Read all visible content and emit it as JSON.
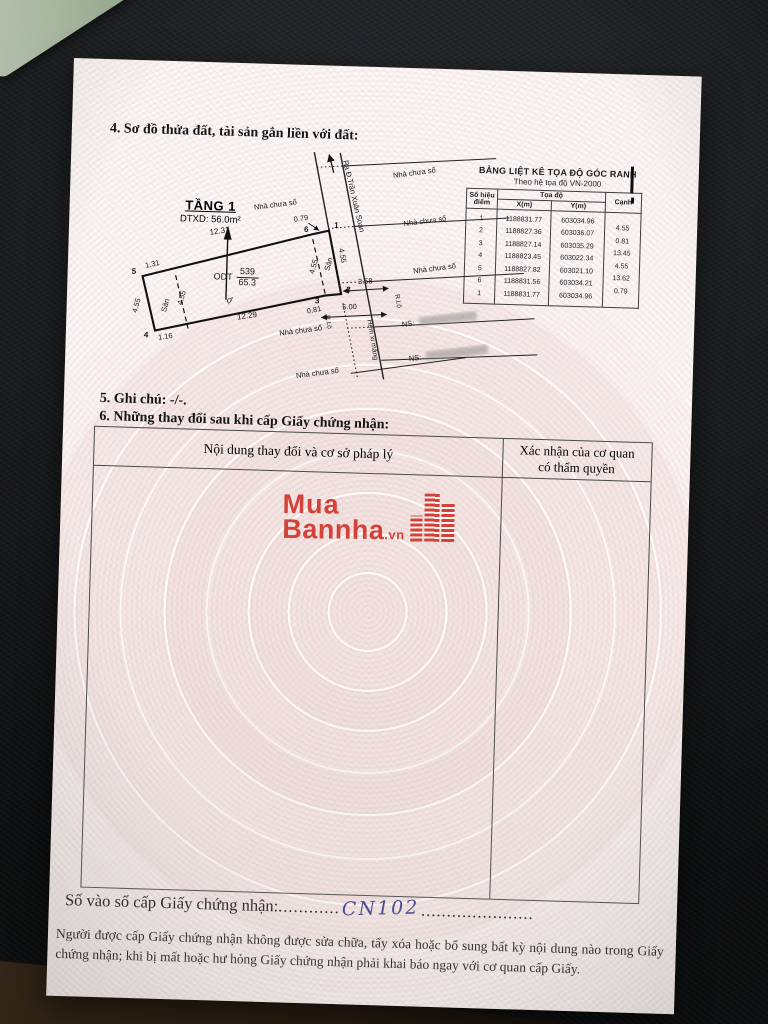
{
  "sections": {
    "s4": "4. Sơ đồ thửa đất, tài sản gắn liền với đất:",
    "s5": "5. Ghi chú: -/-.",
    "s6": "6. Những thay đổi sau khi cấp Giấy chứng nhận:"
  },
  "coord_table": {
    "title": "BẢNG LIỆT KÊ TỌA ĐỘ GÓC RANH",
    "subtitle": "Theo hệ tọa độ VN-2000",
    "col_point": "Số hiệu điểm",
    "col_coords": "Tọa độ",
    "col_x": "X(m)",
    "col_y": "Y(m)",
    "col_edge": "Cạnh",
    "rows": [
      {
        "p": "1",
        "x": "1188831.77",
        "y": "603034.96",
        "edge": ""
      },
      {
        "p": "2",
        "x": "1188827.36",
        "y": "603036.07",
        "edge": "4.55"
      },
      {
        "p": "3",
        "x": "1188827.14",
        "y": "603035.29",
        "edge": "0.81"
      },
      {
        "p": "4",
        "x": "1188823.45",
        "y": "603022.34",
        "edge": "13.45"
      },
      {
        "p": "5",
        "x": "1188827.82",
        "y": "603021.10",
        "edge": "4.55"
      },
      {
        "p": "6",
        "x": "1188831.56",
        "y": "603034.21",
        "edge": "13.62"
      },
      {
        "p": "1",
        "x": "1188831.77",
        "y": "603034.96",
        "edge": "0.79"
      }
    ]
  },
  "diagram": {
    "floor_label": "TẦNG 1",
    "floor_area": "DTXD: 56.0m²",
    "land_use": "ODT",
    "plot_number": "539",
    "plot_area": "65.3",
    "plot_letter": "ợ",
    "street_label": "Ra Đ.Trần Xuân Soạn",
    "alley_label": "Hẻm xi măng",
    "road_label_1": "R.Lộ",
    "road_label_2": "R.Lộ",
    "yard_left": "Sân",
    "yard_right": "Sân",
    "ns_1": "NS:",
    "ns_2": "NS:",
    "houses": [
      "Nhà chưa số",
      "Nhà chưa số",
      "Nhà chưa số",
      "Nhà chưa số",
      "Nhà chưa số",
      "Nhà chưa số"
    ],
    "points": {
      "p1": "1",
      "p2": "2",
      "p3": "3",
      "p4": "4",
      "p5": "5",
      "p6": "6"
    },
    "dims": {
      "top": "12.31",
      "bottom": "12.29",
      "left": "4.55",
      "top_left": "1.31",
      "bottom_left": "1.16",
      "yard_left_w": "4.55",
      "yard_right_w": "4.55",
      "frontage": "4.55",
      "edge_6_1": "0.79",
      "edge_2_3": "0.81",
      "alley_w1": "3.58",
      "alley_w2": "5.00"
    }
  },
  "changes_table": {
    "col_content": "Nội dung thay đổi và cơ sở pháp lý",
    "col_confirm_1": "Xác nhận của cơ quan",
    "col_confirm_2": "có thẩm quyền"
  },
  "watermark": {
    "word1": "Mua",
    "word2": "Bannha",
    "tld": ".vn"
  },
  "book_entry": {
    "label": "Số vào sổ cấp Giấy chứng nhận:",
    "dots1": "............",
    "value": "CN102",
    "dots2": "......................"
  },
  "footer": {
    "text": "Người được cấp Giấy chứng nhận không được sửa chữa, tẩy xóa hoặc bổ sung bất kỳ nội dung nào trong Giấy chứng nhận; khi bị mất hoặc hư hỏng Giấy chứng nhận phải khai báo ngay với cơ quan cấp Giấy."
  },
  "colors": {
    "logo_red": "#d1352b",
    "ink_blue": "#3b3f8e",
    "pattern_pink": "#dfc3c1"
  }
}
